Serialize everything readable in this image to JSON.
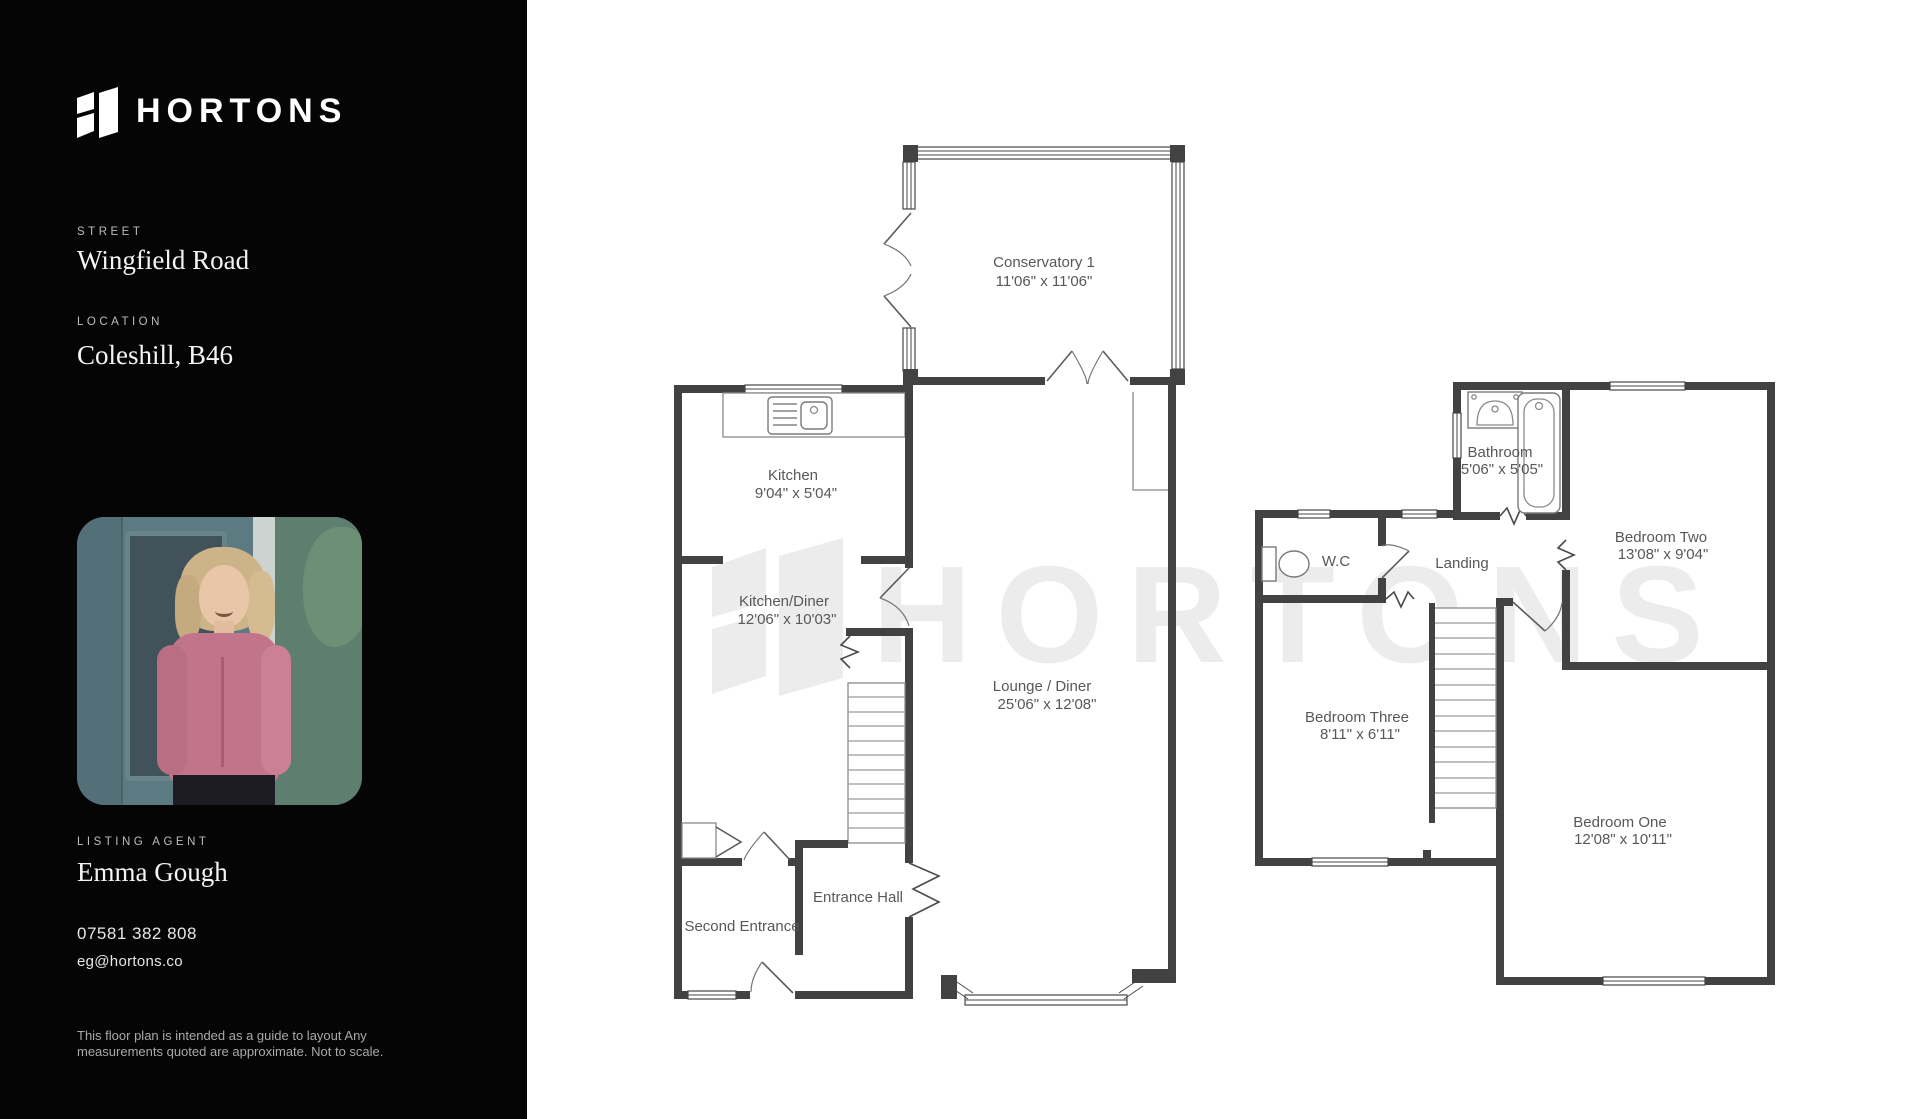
{
  "sidebar": {
    "logo_text": "HORTONS",
    "street": {
      "label": "STREET",
      "value": "Wingfield Road"
    },
    "location": {
      "label": "LOCATION",
      "value": "Coleshill, B46"
    },
    "agent": {
      "label": "LISTING AGENT",
      "name": "Emma Gough",
      "phone": "07581 382 808",
      "email": "eg@hortons.co"
    },
    "disclaimer": {
      "line1": "This floor plan is intended  as a guide to layout Any",
      "line2": "measurements quoted are approximate. Not to scale."
    }
  },
  "watermark": {
    "text": "HORTONS"
  },
  "colors": {
    "sidebar_bg": "#050505",
    "wall": "#424242",
    "plan_text": "#585858",
    "watermark": "#ececec",
    "photo_door_teal": "#5b7a81",
    "photo_blouse_pink": "#c2758a"
  },
  "floor_plan": {
    "ground": {
      "rooms": [
        {
          "id": "conservatory",
          "name": "Conservatory 1",
          "dims": "11'06\" x 11'06\""
        },
        {
          "id": "kitchen",
          "name": "Kitchen",
          "dims": "9'04\" x 5'04\""
        },
        {
          "id": "kitchen_diner",
          "name": "Kitchen/Diner",
          "dims": "12'06\" x 10'03\""
        },
        {
          "id": "lounge_diner",
          "name": "Lounge / Diner",
          "dims": "25'06\" x 12'08\""
        },
        {
          "id": "entrance_hall",
          "name": "Entrance Hall",
          "dims": ""
        },
        {
          "id": "second_entrance",
          "name": "Second Entrance",
          "dims": ""
        }
      ]
    },
    "first": {
      "rooms": [
        {
          "id": "bathroom",
          "name": "Bathroom",
          "dims": "5'06\" x 5'05\""
        },
        {
          "id": "wc",
          "name": "W.C",
          "dims": ""
        },
        {
          "id": "landing",
          "name": "Landing",
          "dims": ""
        },
        {
          "id": "bedroom_two",
          "name": "Bedroom Two",
          "dims": "13'08\" x 9'04\""
        },
        {
          "id": "bedroom_three",
          "name": "Bedroom Three",
          "dims": "8'11\" x 6'11\""
        },
        {
          "id": "bedroom_one",
          "name": "Bedroom One",
          "dims": "12'08\" x 10'11\""
        }
      ]
    }
  }
}
